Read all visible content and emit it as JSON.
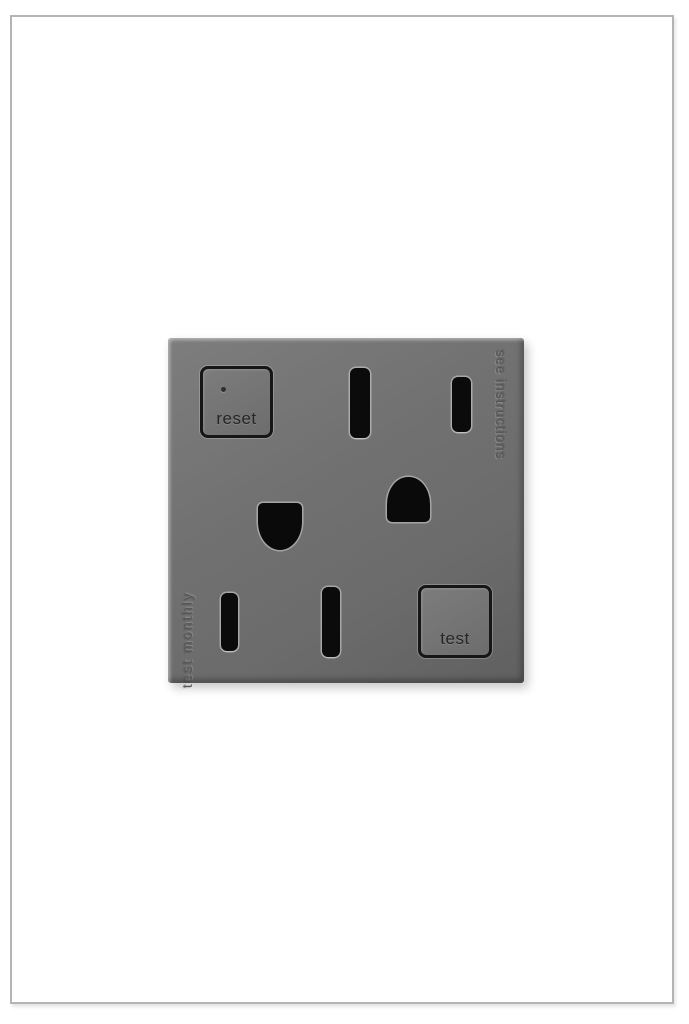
{
  "window": {
    "background": "#ffffff",
    "frame_border_color": "#b4b4b4"
  },
  "outlet": {
    "type": "gfci-duplex-outlet",
    "face_color": "#6f6f6f",
    "slot_color": "#0b0b0b",
    "button_border_color": "#161616",
    "engraving_color": "#565656",
    "buttons": {
      "reset_label": "reset",
      "test_label": "test"
    },
    "engravings": {
      "left_vertical_text": "test monthly",
      "right_vertical_text": "see instructions"
    },
    "openings": [
      "neutral-slot-top",
      "hot-slot-top",
      "ground-hole-top",
      "ground-hole-bottom",
      "hot-slot-bottom",
      "neutral-slot-bottom"
    ]
  }
}
